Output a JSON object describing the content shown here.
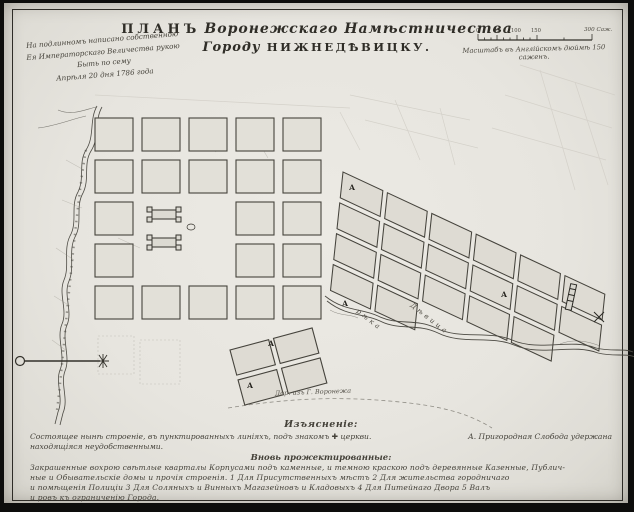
{
  "colors": {
    "paper": "#e8e6e0",
    "ink": "#35332c",
    "frame": "#2e2c27",
    "faint_pencil": "#c6c3ba",
    "block_fill": "#e0ded6"
  },
  "title": {
    "word_plan": "ПЛАНЪ",
    "script_region": "Воронежскаго Намѣстничества",
    "word_city": "Городу",
    "city_name": "НИЖНЕДѢВИЦКУ."
  },
  "imperial_note": {
    "lines": [
      "На подлинномъ написано собственною",
      "Ея Императорскаго Величества рукою",
      "Быть по сему",
      "Апрѣля 20 дня 1786 года"
    ]
  },
  "scale_bar": {
    "ticks": [
      "0",
      "50",
      "100",
      "150"
    ],
    "end_label": "300 Саж.",
    "caption": "Масштабъ въ Англійскомъ дюймѣ 150 саженъ."
  },
  "map_labels": {
    "block_marker": "А",
    "river_word": "рѣка",
    "river_name": "Дѣвица",
    "road_label": "Дор. изъ Г. Воронежа"
  },
  "legend": {
    "heading": "Изъясненіе:",
    "line1_left": "Состоящее нынѣ строеніе, въ пунктированныхъ линіяхъ, подъ знакомъ ✚ церкви.",
    "line1_right": "А. Пригородная Слобода удержана",
    "line2": "находящіяся неудобственными.",
    "subheading": "Вновь прожектированные:",
    "para": [
      "Закрашенные вохрою свѣтлые кварталы Корпусами подъ каменные, и темною краскою подъ деревянные Казенные, Публич-",
      "ные и Обывательскіе домы и прочія строенія.    1 Для Присутственныхъ мѣстъ  2 Для жительства городничаго",
      "и помѣщенія Полиціи  3 Для Соляныхъ и Винныхъ Магазейновъ и Кладовыхъ  4 Для Питейнаго Двора  5 Валъ",
      "и ровъ къ ограниченію Города."
    ]
  }
}
